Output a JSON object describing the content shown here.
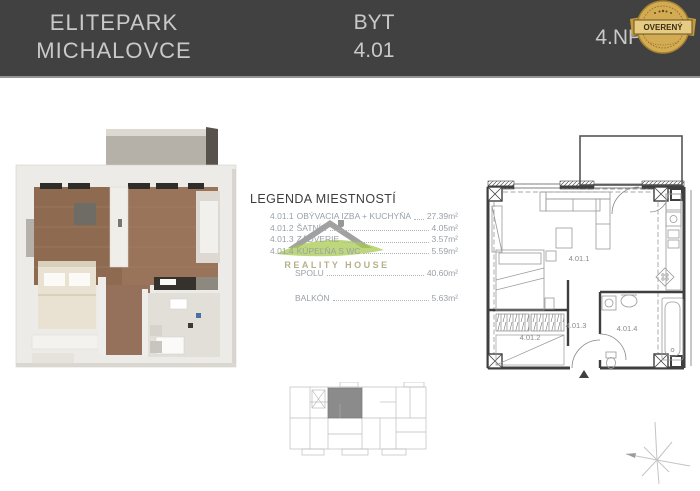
{
  "header": {
    "project_name_line1": "ELITEPARK",
    "project_name_line2": "MICHALOVCE",
    "unit_label": "BYT",
    "unit_number": "4.01",
    "floor_label": "4.NP",
    "badge": {
      "text": "OVERENÝ"
    }
  },
  "legend": {
    "title": "LEGENDA MIESTNOSTÍ",
    "rooms": [
      {
        "code": "4.01.1",
        "name": "OBÝVACIA IZBA + KUCHYŇA",
        "area": "27.39m²"
      },
      {
        "code": "4.01.2",
        "name": "ŠATNÍK",
        "area": "4.05m²"
      },
      {
        "code": "4.01.3",
        "name": "ZÁDVERIE",
        "area": "3.57m²"
      },
      {
        "code": "4.01.4",
        "name": "KÚPEĽŇA S WC",
        "area": "5.59m²"
      }
    ],
    "total": {
      "label": "SPOLU",
      "area": "40.60m²"
    },
    "balcony": {
      "label": "BALKÓN",
      "area": "5.63m²"
    }
  },
  "watermark": {
    "brand": "REALITY HOUSE"
  },
  "floorplan_2d": {
    "room_labels": [
      "4.01.1",
      "4.01.2",
      "4.01.3",
      "4.01.4"
    ]
  },
  "colors": {
    "header_bg": "#414141",
    "header_text": "#c9c9c9",
    "badge_gold": "#d2ab52",
    "legend_text": "#99a0a8",
    "wood_floor": "#9a745a",
    "plan_line": "#3f3f3f",
    "highlight_unit": "#8b8b8b",
    "watermark_green": "#9fc43e"
  }
}
